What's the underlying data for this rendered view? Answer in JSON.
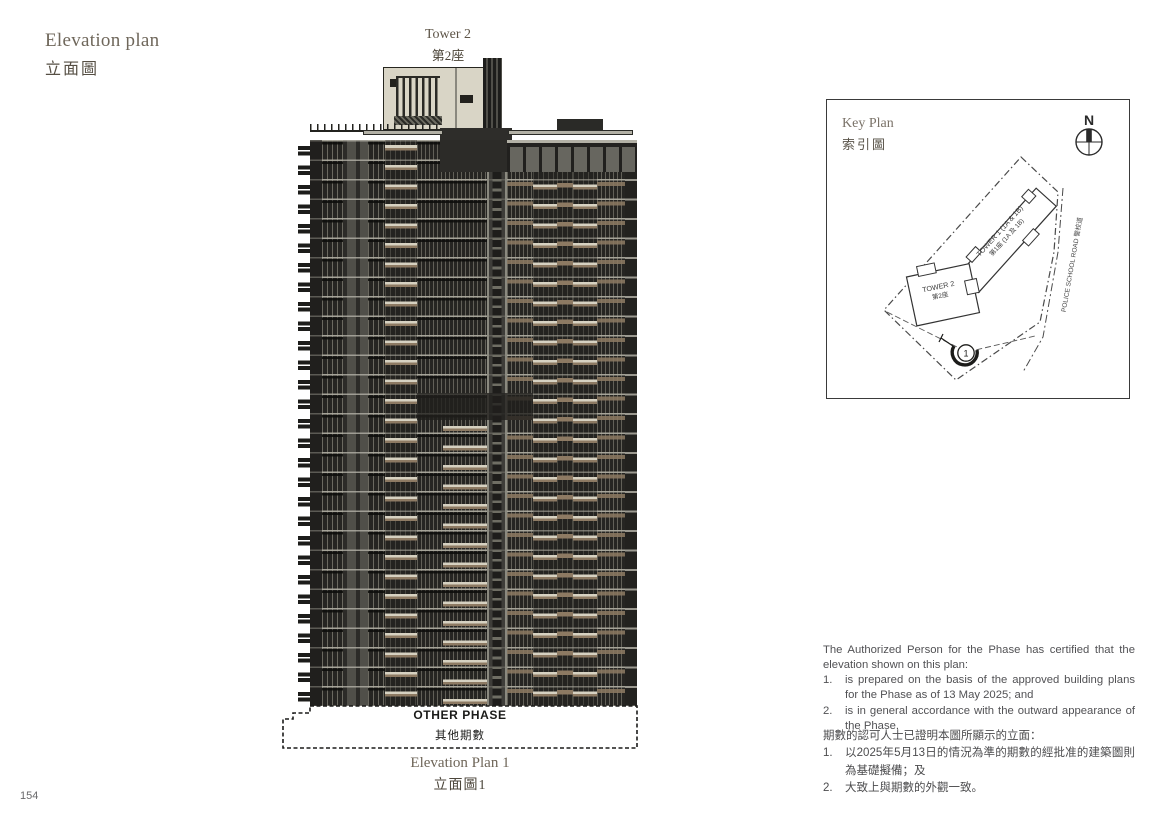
{
  "page": {
    "number": "154"
  },
  "header": {
    "title_en": "Elevation plan",
    "title_zh": "立面圖"
  },
  "tower_label": {
    "en": "Tower 2",
    "zh": "第2座"
  },
  "building": {
    "colors": {
      "charcoal": "#2b2a27",
      "panel": "#504f49",
      "cream_balcony": "#d6d1c1",
      "tan_accent": "#8d7a63",
      "roof": "#d9d5c6"
    }
  },
  "other_phase": {
    "en": "OTHER PHASE",
    "zh": "其他期數"
  },
  "caption": {
    "en": "Elevation Plan 1",
    "zh": "立面圖1"
  },
  "key_plan": {
    "title_en": "Key Plan",
    "title_zh": "索引圖",
    "north": "N",
    "tower1_en": "TOWER 1 (1A & 1B)",
    "tower1_zh": "第1座 (1A 及 1B)",
    "tower2_en": "TOWER 2",
    "tower2_zh": "第2座",
    "road": "POLICE SCHOOL ROAD 警校道",
    "marker": "1"
  },
  "certification": {
    "en": {
      "intro": "The Authorized Person for the Phase has certified that the elevation shown on this plan:",
      "markers": [
        "1.",
        "2."
      ],
      "items": [
        "is prepared on the basis of the approved building plans for the Phase as of 13 May 2025; and",
        "is in general accordance with the outward appearance of the Phase."
      ]
    },
    "zh": {
      "intro": "期數的認可人士已證明本圖所顯示的立面：",
      "markers": [
        "1.",
        "2."
      ],
      "items": [
        "以2025年5月13日的情況為準的期數的經批准的建築圖則為基礎擬備；及",
        "大致上與期數的外觀一致。"
      ]
    }
  }
}
